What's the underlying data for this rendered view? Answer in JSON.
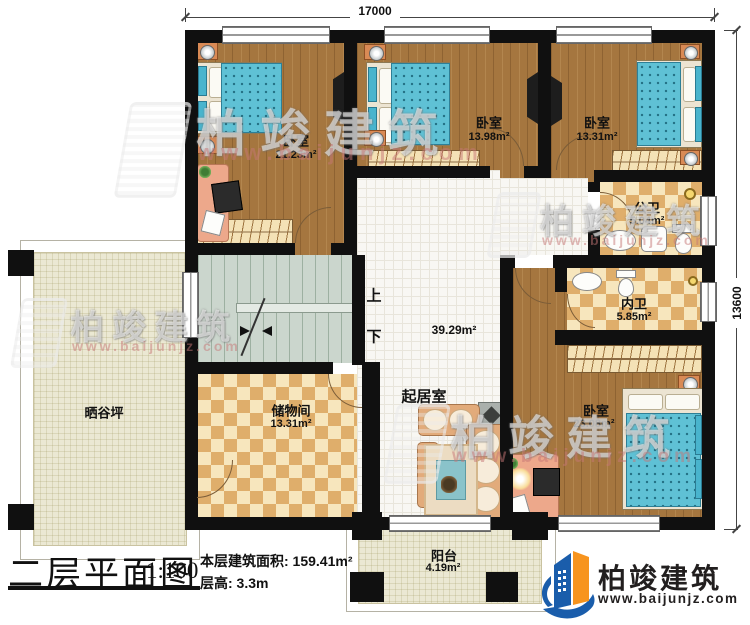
{
  "dimensions": {
    "width_top": "17000",
    "height_right": "13600"
  },
  "rooms": {
    "bedroom_top_left": {
      "name": "卧室",
      "area": "21.23m²"
    },
    "bedroom_top_middle": {
      "name": "卧室",
      "area": "13.98m²"
    },
    "bedroom_top_right": {
      "name": "卧室",
      "area": "13.31m²"
    },
    "public_bathroom": {
      "name": "公卫",
      "area": "5.04m²"
    },
    "ensuite_bathroom": {
      "name": "内卫",
      "area": "5.85m²"
    },
    "bedroom_bottom_right": {
      "name": "卧室",
      "area": "23.08m²"
    },
    "living_room": {
      "name": "起居室",
      "area": "39.29m²"
    },
    "storage_room": {
      "name": "储物间",
      "area": "13.31m²"
    },
    "balcony": {
      "name": "阳台",
      "area": "4.19m²"
    },
    "drying_yard": {
      "name": "晒谷坪"
    }
  },
  "stairs": {
    "up_label": "上",
    "down_label": "下"
  },
  "title_block": {
    "title": "二层平面图",
    "scale": "1:100",
    "floor_area_label": "本层建筑面积: 159.41m²",
    "floor_height_label": "层高: 3.3m"
  },
  "brand": {
    "name": "柏竣建筑",
    "website": "www.baijunjz.com"
  },
  "watermark": {
    "name": "柏竣建筑",
    "website": "www.baijunjz.com"
  },
  "colors": {
    "wall": "#101010",
    "wood_floor": "#a5763f",
    "tile_light": "#f7e6bd",
    "tile_dark": "#dfae6b",
    "mattress": "#5fc1d5",
    "brand_blue": "#1a5dab",
    "brand_orange": "#f7941e"
  }
}
